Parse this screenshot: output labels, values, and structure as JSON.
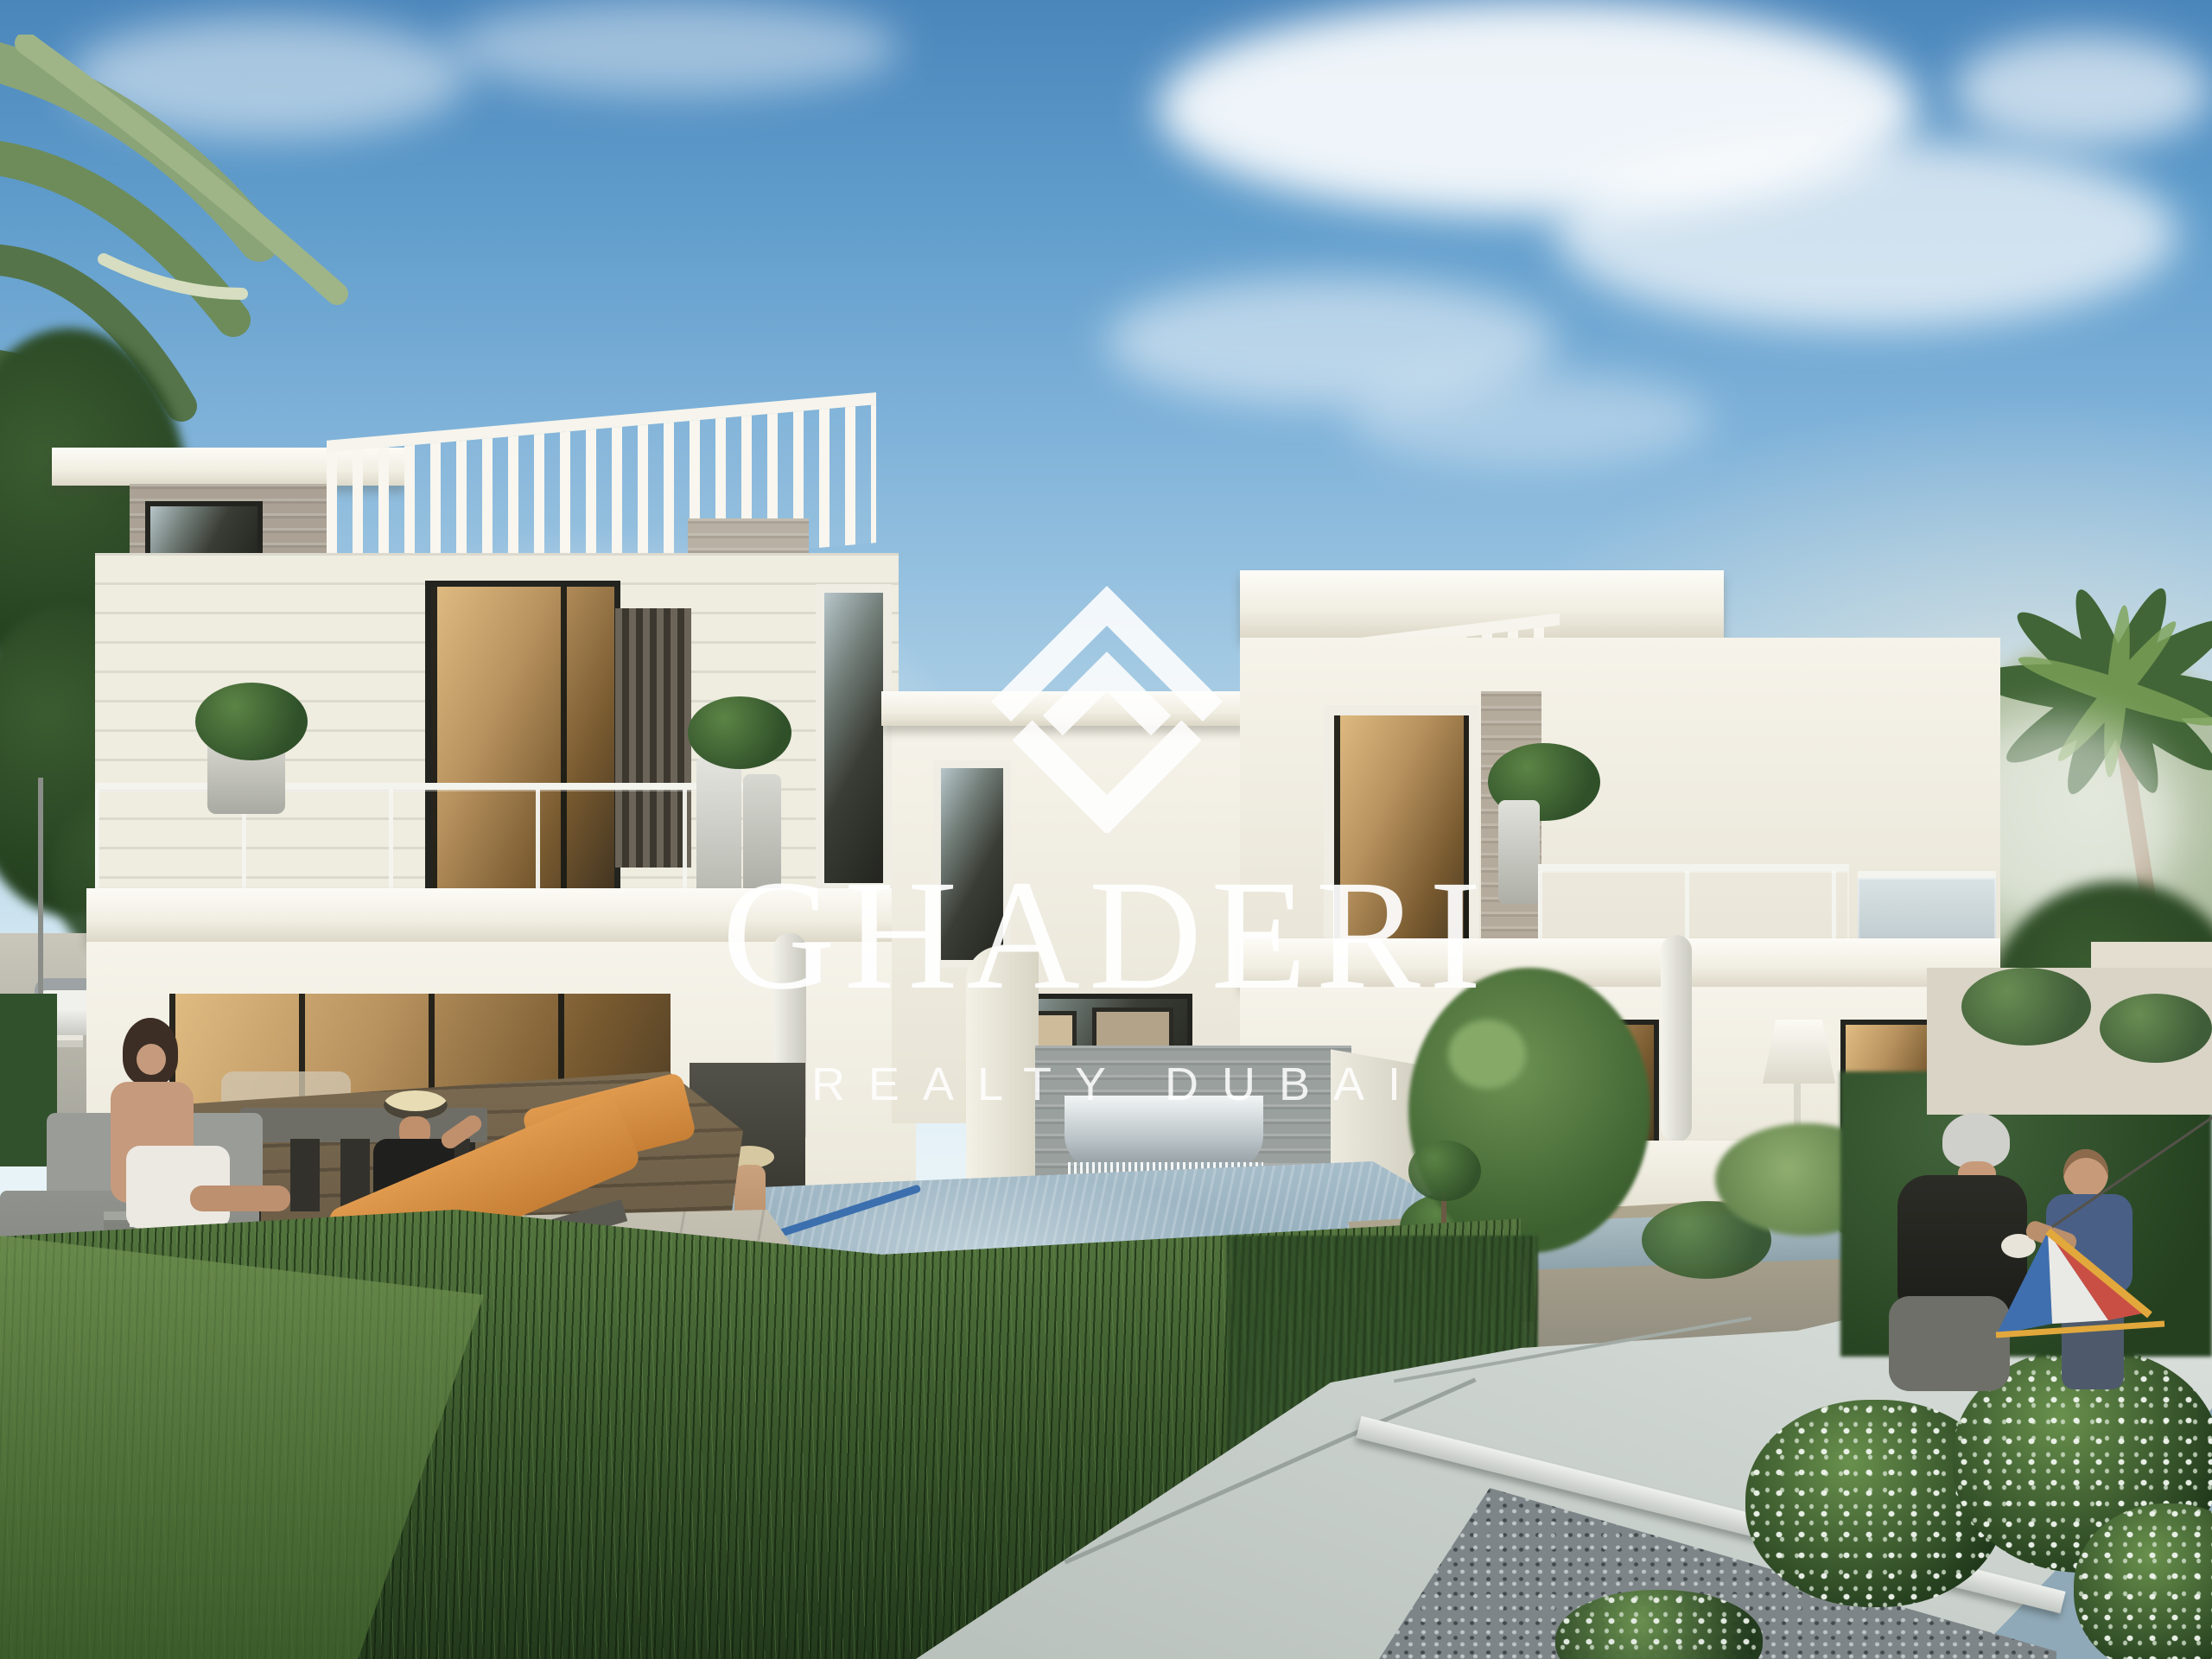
{
  "watermark": {
    "title": "GHADERI",
    "subtitle": "REALTY DUBAI",
    "logo_icon": "diamond-monogram-icon",
    "text_color": "#ffffff"
  },
  "palette": {
    "sky_top": "#4b86bb",
    "sky_horizon": "#e8f3f8",
    "villa_white": "#f5f2e9",
    "stone_cladding": "#aba295",
    "window_glass_warm": "#b9935f",
    "window_frame": "#23241f",
    "pool_water": "#8ea9b9",
    "grass_green": "#4d7038",
    "lounger_orange": "#d9913f",
    "path_concrete": "#ccd3cf",
    "kite_red": "#c94f44",
    "kite_blue": "#3f6fae",
    "kite_yellow": "#e2a83c",
    "kite_white": "#e9e9e6"
  }
}
